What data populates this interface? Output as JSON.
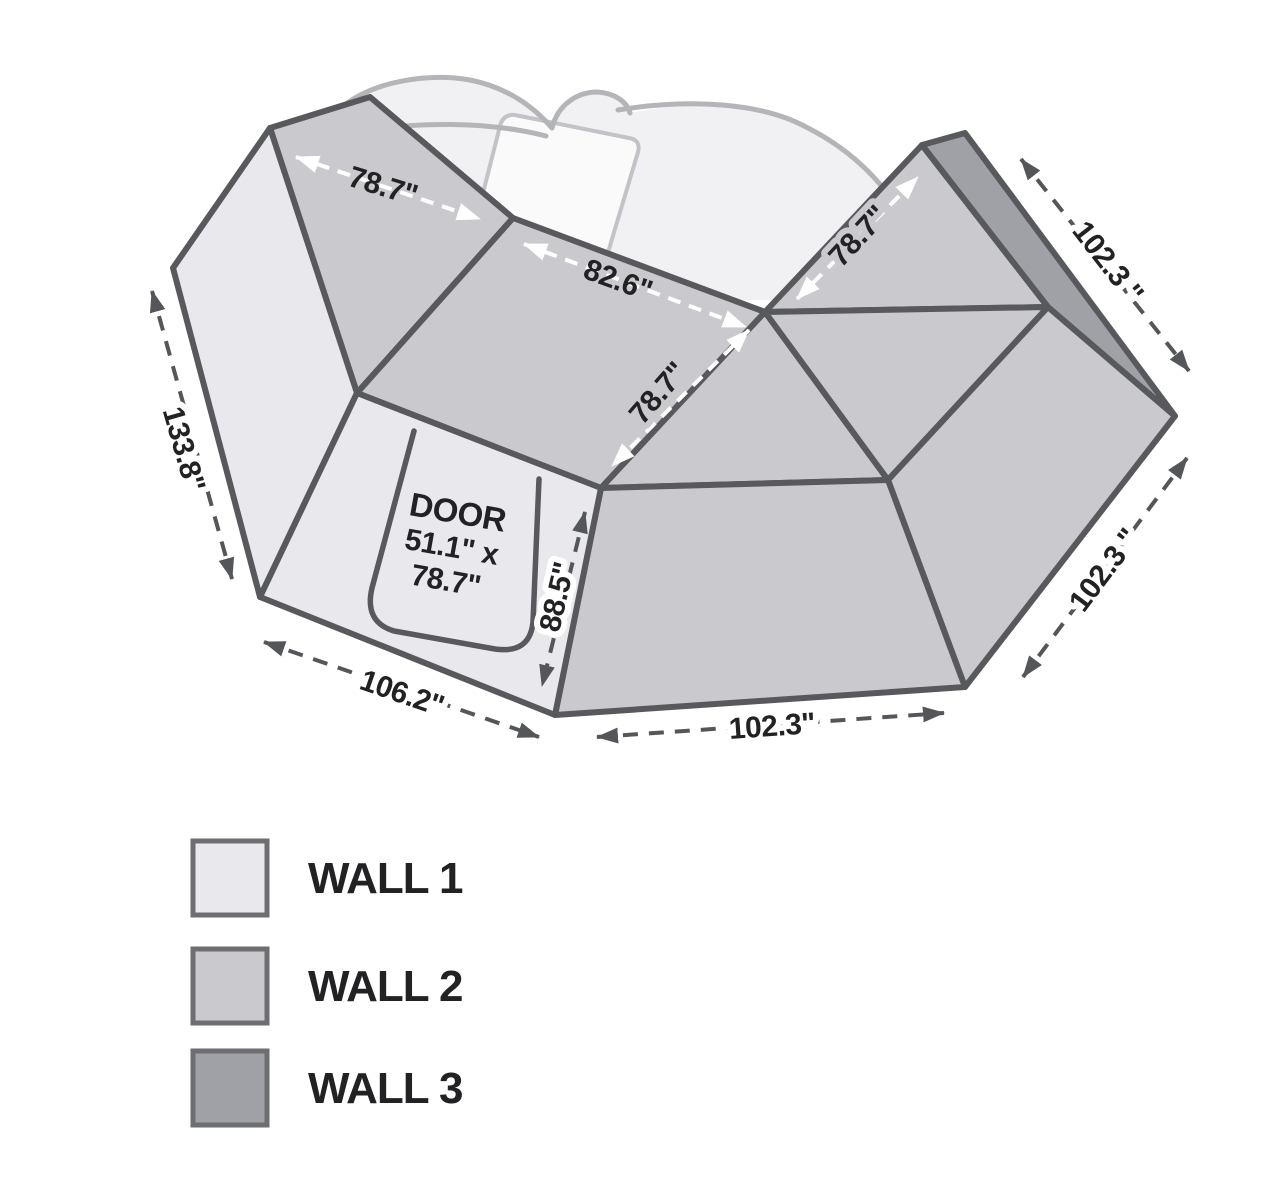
{
  "diagram": {
    "title": "awning wall kit dimensions",
    "colors": {
      "wall1": "#e9e9ed",
      "wall2": "#cacace",
      "wall3": "#a0a1a6",
      "outline": "#58595c"
    },
    "dimensions": {
      "roof_left": "78.7\"",
      "roof_mid": "82.6\"",
      "roof_right_inner": "78.7\"",
      "roof_right_outer": "78.7\"",
      "wall3_top": "102.3 \"",
      "left_height": "133.8\"",
      "bottom_left": "106.2\"",
      "door_side_height": "88.5\"",
      "bottom_mid": "102.3\"",
      "right_lower": "102.3 \""
    },
    "door_label": {
      "title": "DOOR",
      "size_line1": "51.1\" x",
      "size_line2": "78.7\""
    }
  },
  "legend": {
    "items": [
      {
        "label": "WALL 1",
        "color": "#e9e9ed"
      },
      {
        "label": "WALL 2",
        "color": "#cacace"
      },
      {
        "label": "WALL 3",
        "color": "#a0a1a6"
      }
    ]
  }
}
